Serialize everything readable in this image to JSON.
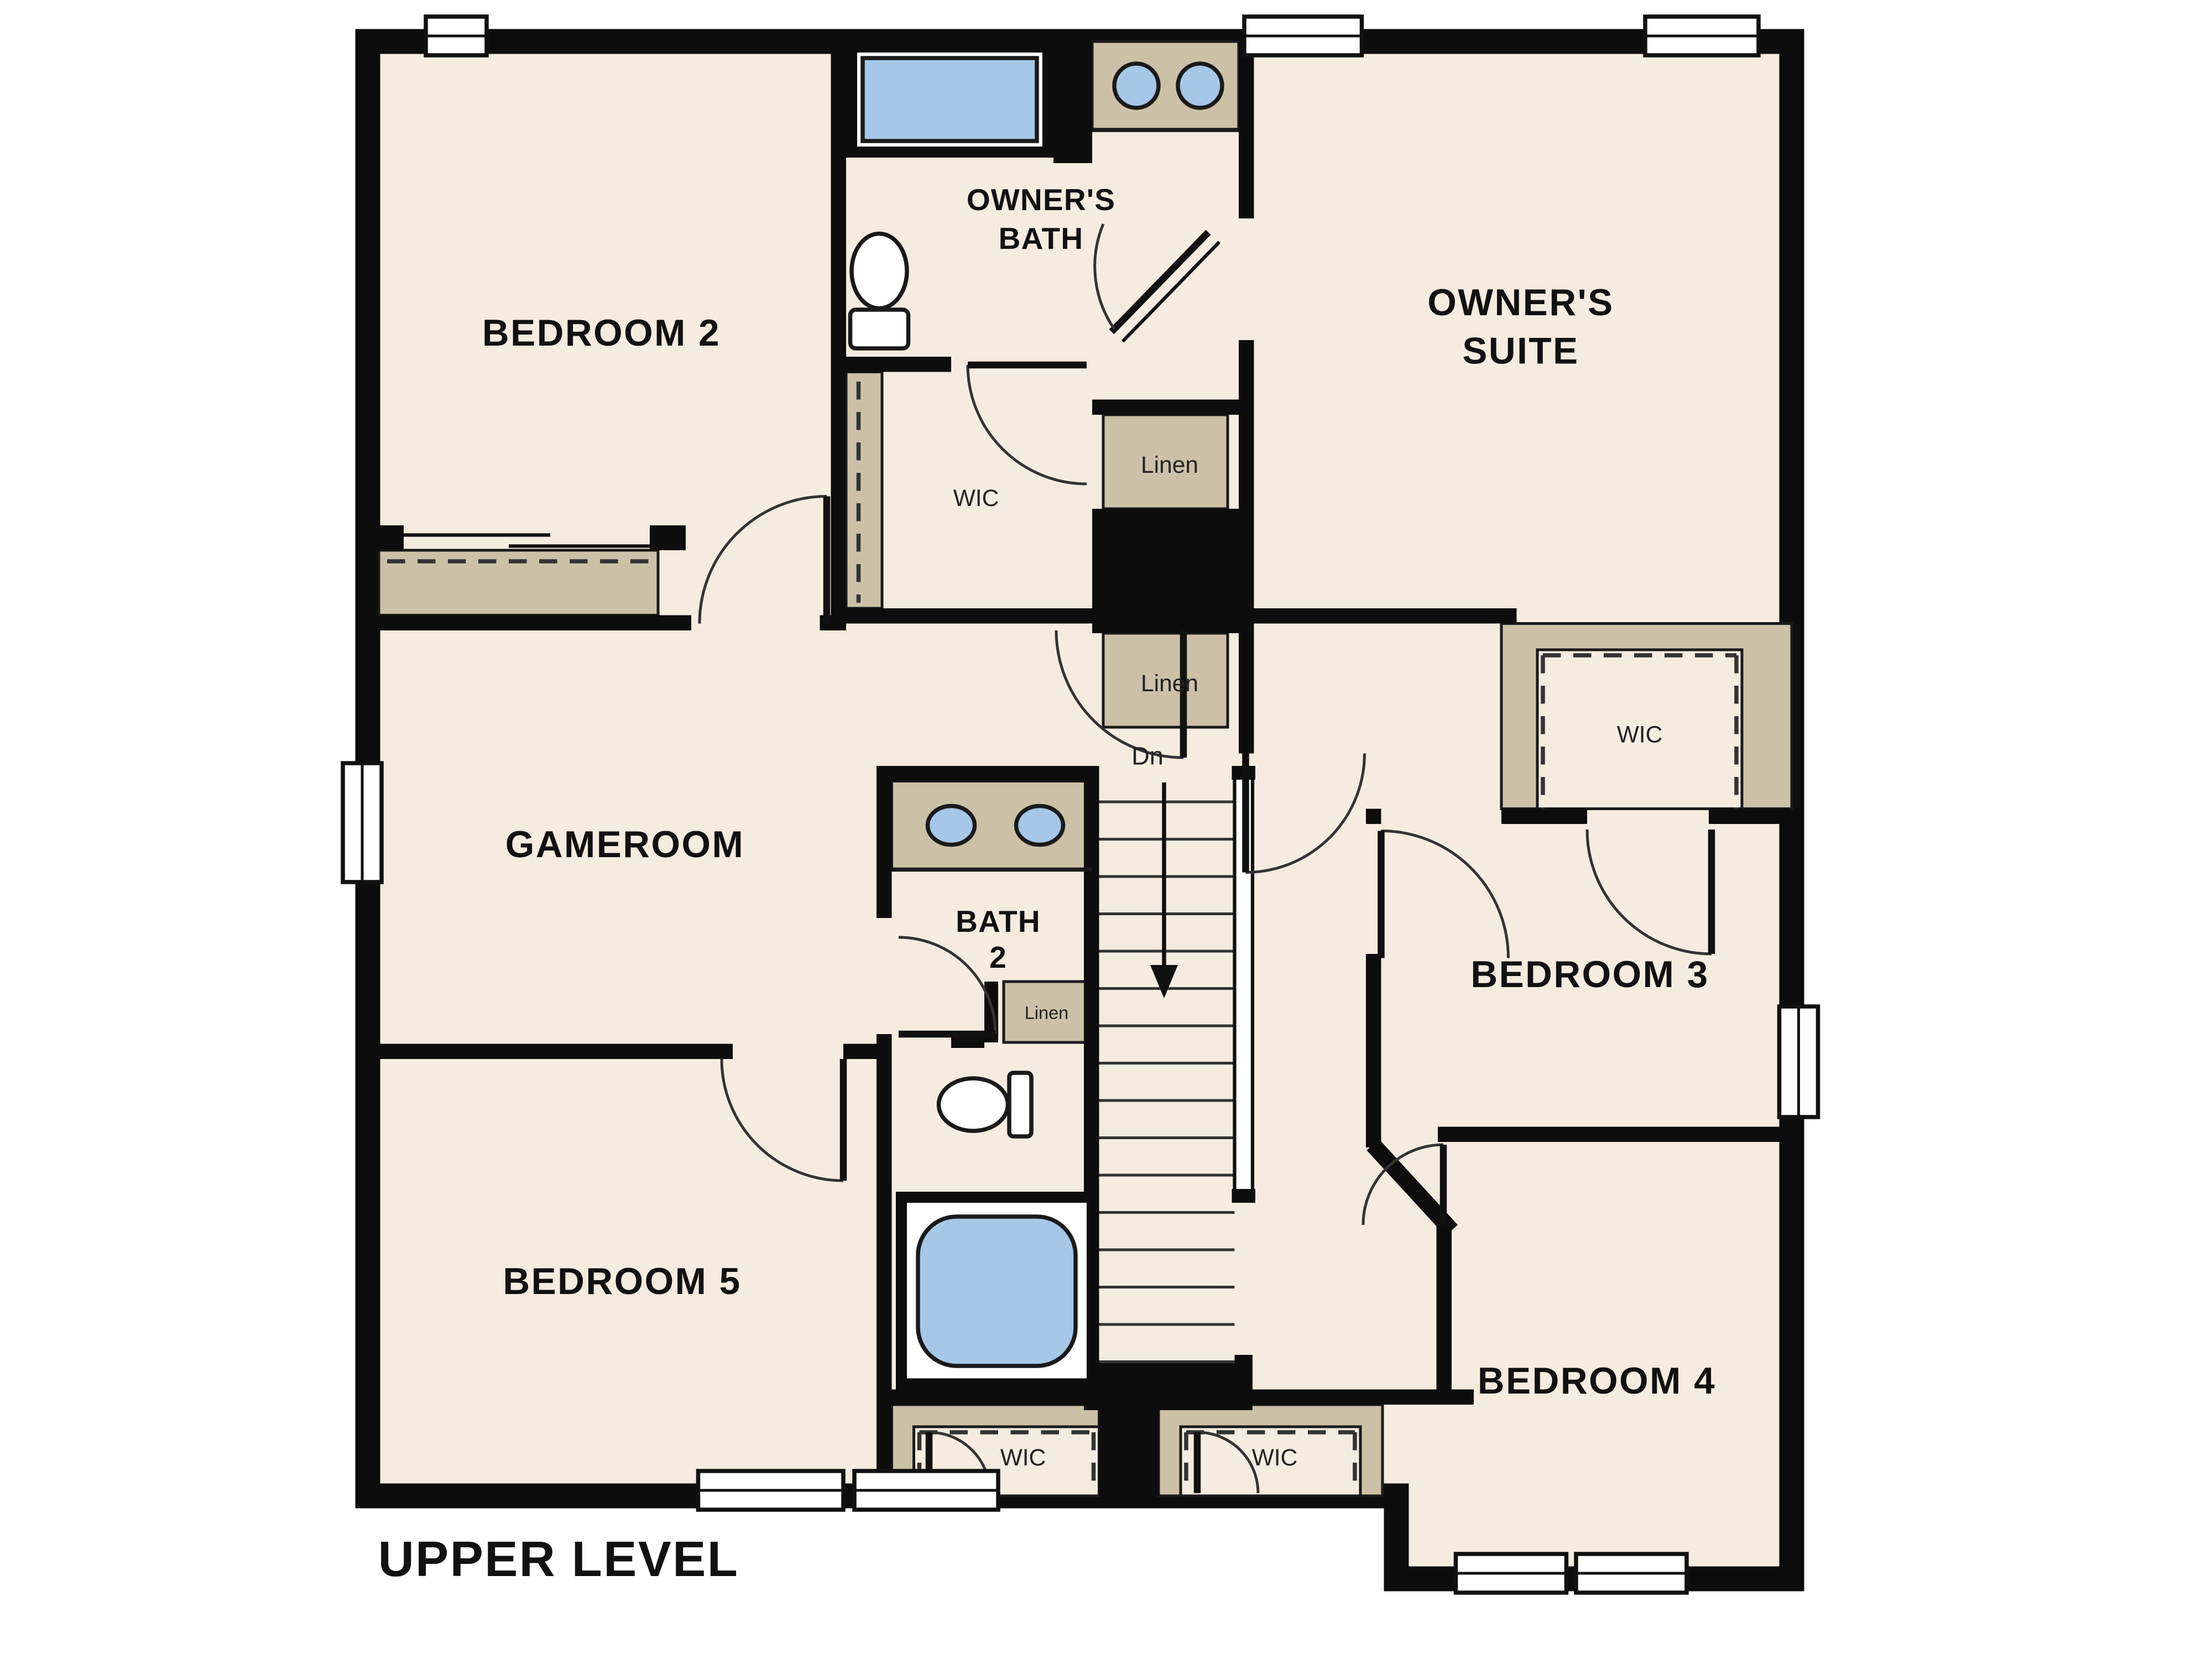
{
  "plan": {
    "title": "UPPER LEVEL",
    "colors": {
      "floor": "#f4ecdf",
      "wall": "#0d0d0d",
      "closet_tan": "#ccc1a7",
      "fixture_blue": "#a6c7e7",
      "background": "#ffffff"
    },
    "rooms": {
      "bedroom2": {
        "label": "BEDROOM 2"
      },
      "owners_bath": {
        "line1": "OWNER'S",
        "line2": "BATH"
      },
      "owners_suite": {
        "line1": "OWNER'S",
        "line2": "SUITE"
      },
      "gameroom": {
        "label": "GAMEROOM"
      },
      "bath2": {
        "line1": "BATH",
        "line2": "2"
      },
      "bedroom3": {
        "label": "BEDROOM 3"
      },
      "bedroom4": {
        "label": "BEDROOM 4"
      },
      "bedroom5": {
        "label": "BEDROOM 5"
      }
    },
    "closets": {
      "linen_upper": "Linen",
      "linen_lower": "Linen",
      "linen_bath2": "Linen",
      "wic_owners": "WIC",
      "wic_bedroom3": "WIC",
      "wic_bedroom5": "WIC",
      "wic_bedroom4": "WIC"
    },
    "stairs": {
      "label": "Dn"
    }
  }
}
